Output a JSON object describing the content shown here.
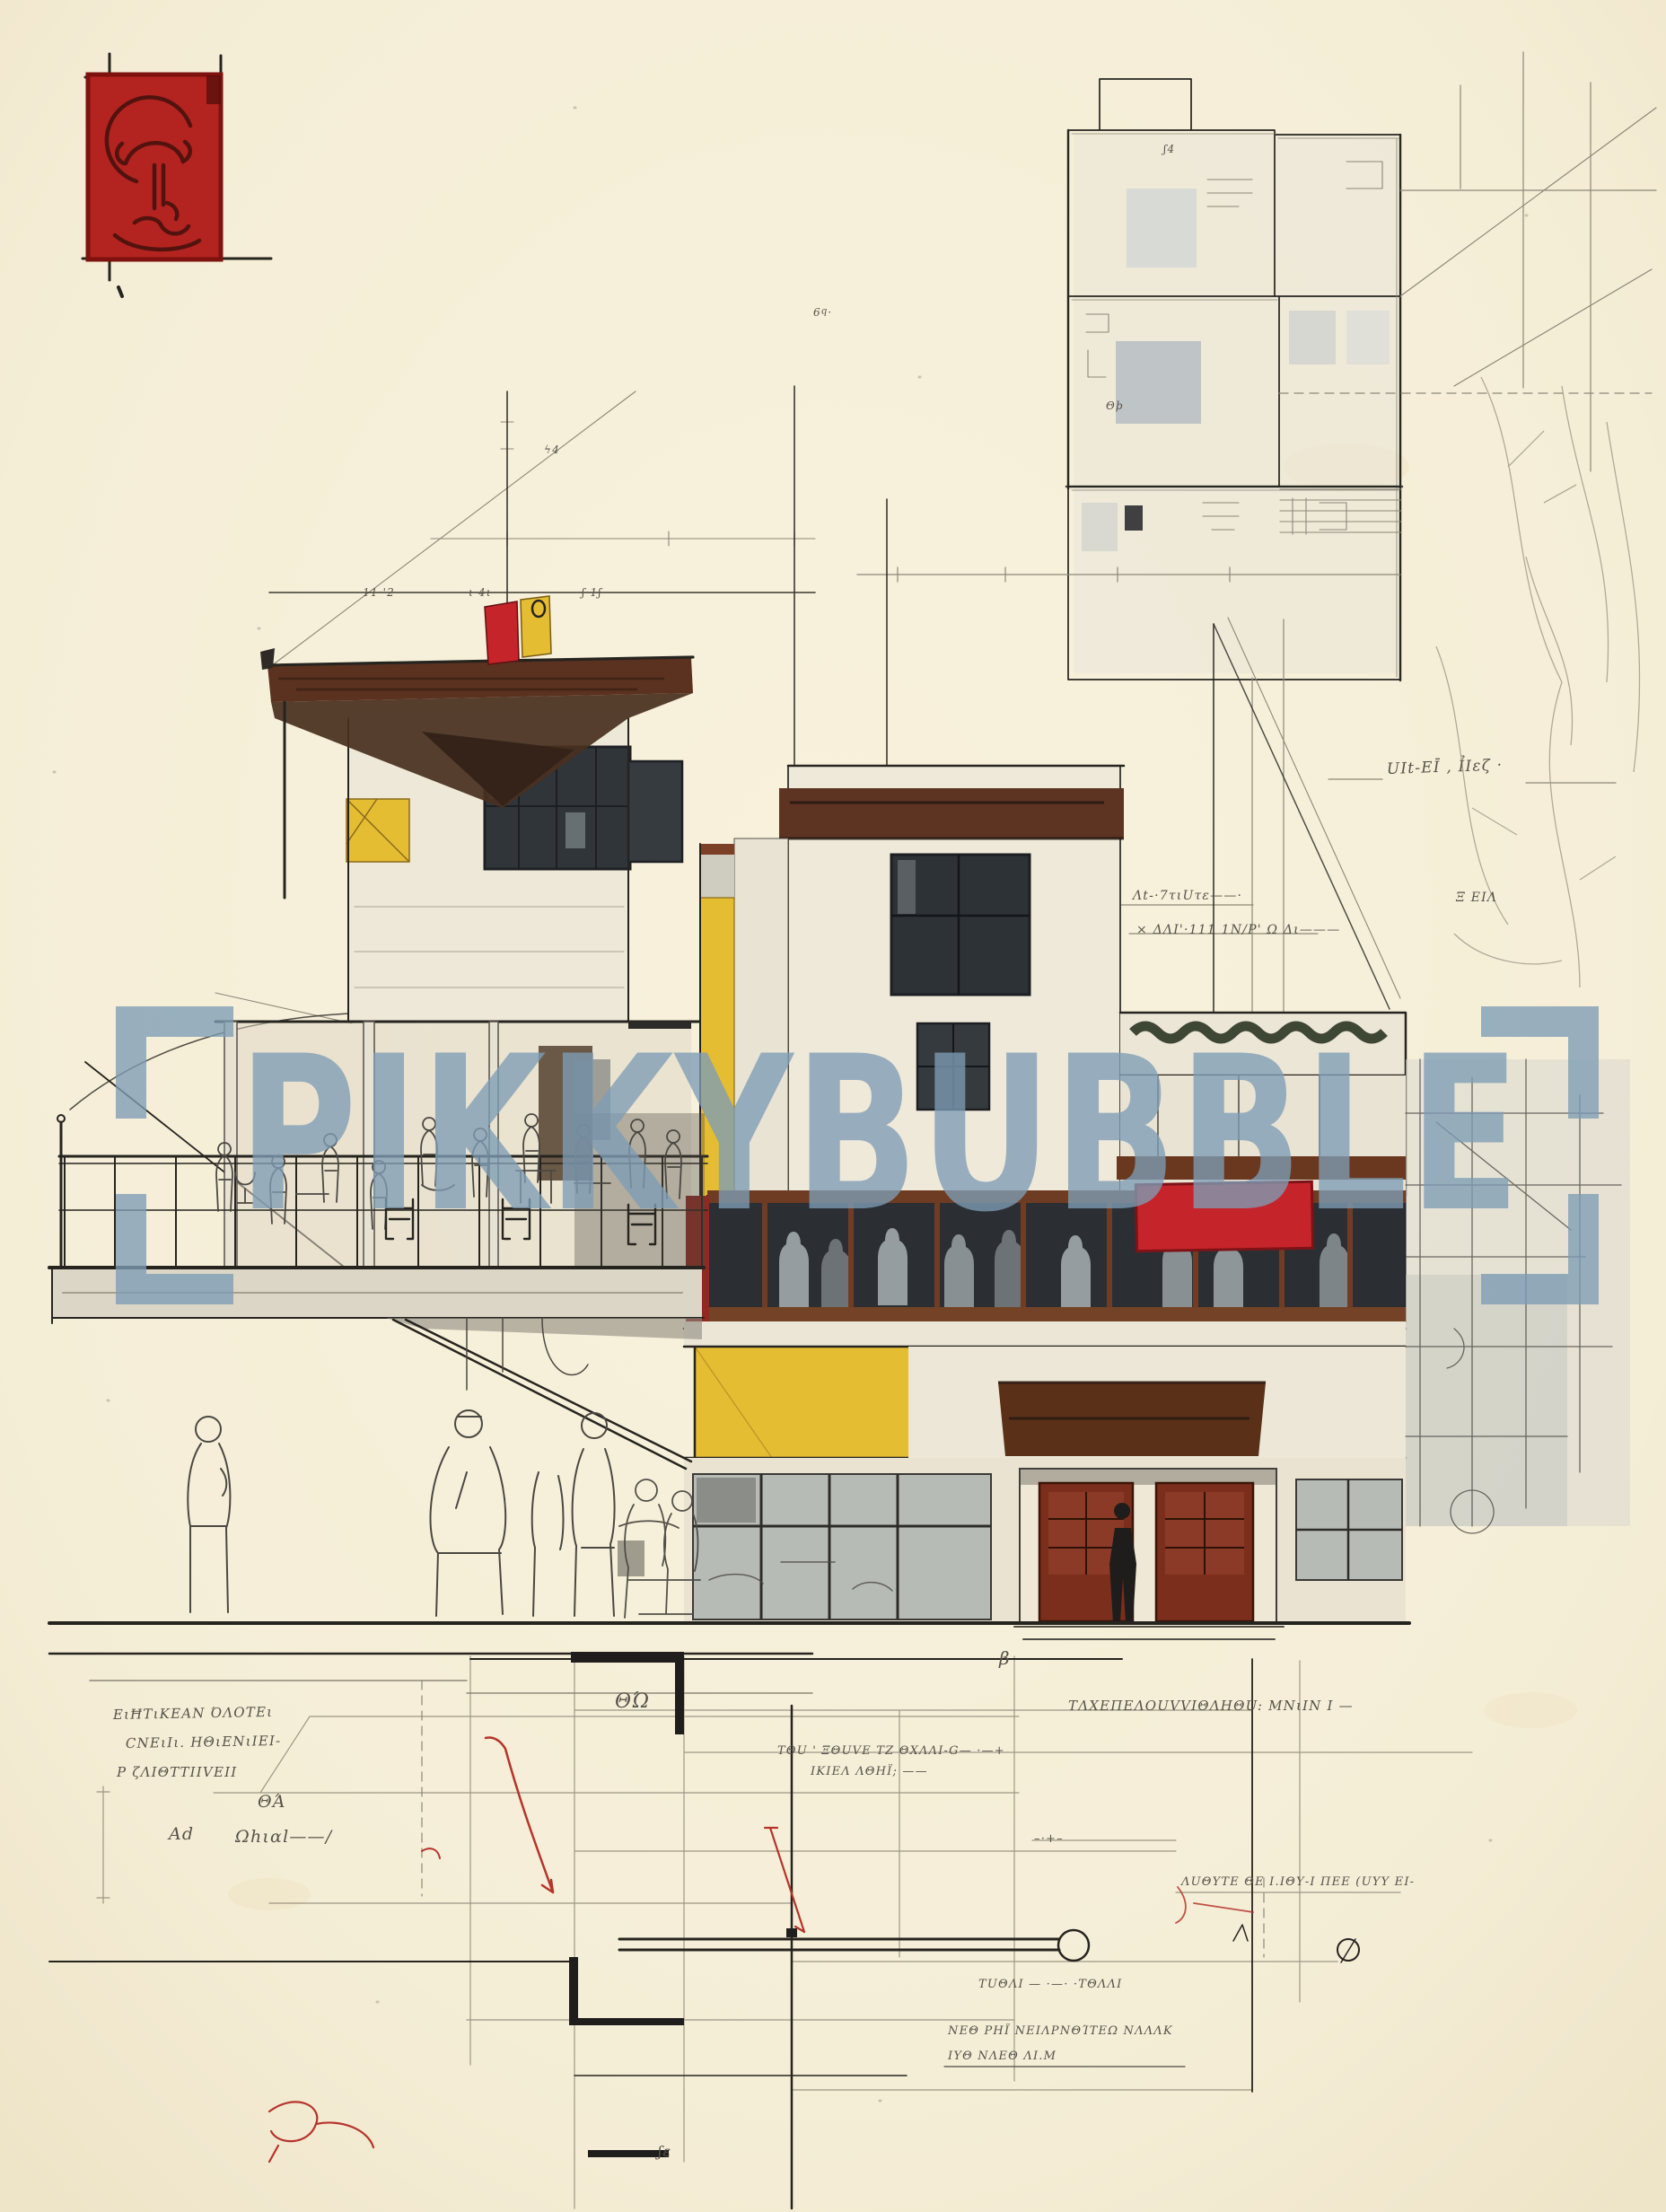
{
  "artwork": {
    "type": "architectural concept sketch",
    "subject": "modernist cafe building elevation in ink and watercolor with floor plan, terrace figures and measurement scribbles"
  },
  "palette": {
    "paper": "#f6efd9",
    "ink": "#26241f",
    "pencil": "#8d8778",
    "roof_brown": "#5b3120",
    "seal_red": "#b3231f",
    "accent_red": "#c5242a",
    "accent_yellow": "#e5bd33",
    "glazing_dark": "#2b2f33",
    "wash_gray": "#b7bbb6",
    "watermark_blue": "#7d9cb5",
    "annotation_ink": "#57524a",
    "markup_red": "#b5342c"
  },
  "watermark": {
    "open_bracket": "[",
    "text": "PIKKYBUBBLE",
    "close_bracket": "]"
  },
  "seal": {
    "glyph": "abstract-figure-stamp"
  },
  "annotations": [
    {
      "text": "ΕιĦΤιΚΕΑΝ ΌΛΟΤΕι"
    },
    {
      "text": "CΝΕιΙι. ΗΘιΕΝιΙΕΙ-"
    },
    {
      "text": "Ρ ζΛΙΘΤΤΙΙVΕΙΙ"
    },
    {
      "text": "ΘΆ"
    },
    {
      "text": "Αd"
    },
    {
      "text": "Ωhιαl——/"
    },
    {
      "text": "UIt-ΕĪ , ỈΙεζ ·"
    },
    {
      "text": "Λt-·7τιUτε——·"
    },
    {
      "text": "× ΔΛΙ'·111 1Ν/Ρ' Ω Δι———"
    },
    {
      "text": "Ξ ΕΙΛ"
    },
    {
      "text": "ΤΛΧΕΠΕΛΟUVVΙΘΛΗΘU: ΜΝιΙΝ Ι —"
    },
    {
      "text": "ΤΘU ' ΞΘUVΕ ΤΖ ΘΧΛΛΙ-G— ·—+"
    },
    {
      "text": "ΙΚΙΕΛ ΛΘΗΪ; ——"
    },
    {
      "text": "ΛUΘΥΤΕ ΘΕ Ι.ΙΘΥ-Ι ΠΕΕ (UΥΥ ΕΙ-"
    },
    {
      "text": "ΤUΘΛΙ — ·—· ·ΤΘΛΛΙ"
    },
    {
      "text": "ΝΕΘ ΡΗΪ ΝΕΙΛΡΝΘΊΤΕΩ ΝΛΛΛΚ"
    },
    {
      "text": "ΙΥΘ ΝΛΕΘ ΛΙ.Μ"
    },
    {
      "text": "11·'2"
    },
    {
      "text": "ι·4ι"
    },
    {
      "text": "ʃ·1ʃ"
    },
    {
      "text": "6ϥ·"
    },
    {
      "text": "ʃ4"
    },
    {
      "text": "Θϸ"
    },
    {
      "text": "β"
    },
    {
      "text": "ΘΏ"
    },
    {
      "text": "ʃε"
    },
    {
      "text": "ϟ4"
    },
    {
      "text": "–·+–"
    }
  ]
}
